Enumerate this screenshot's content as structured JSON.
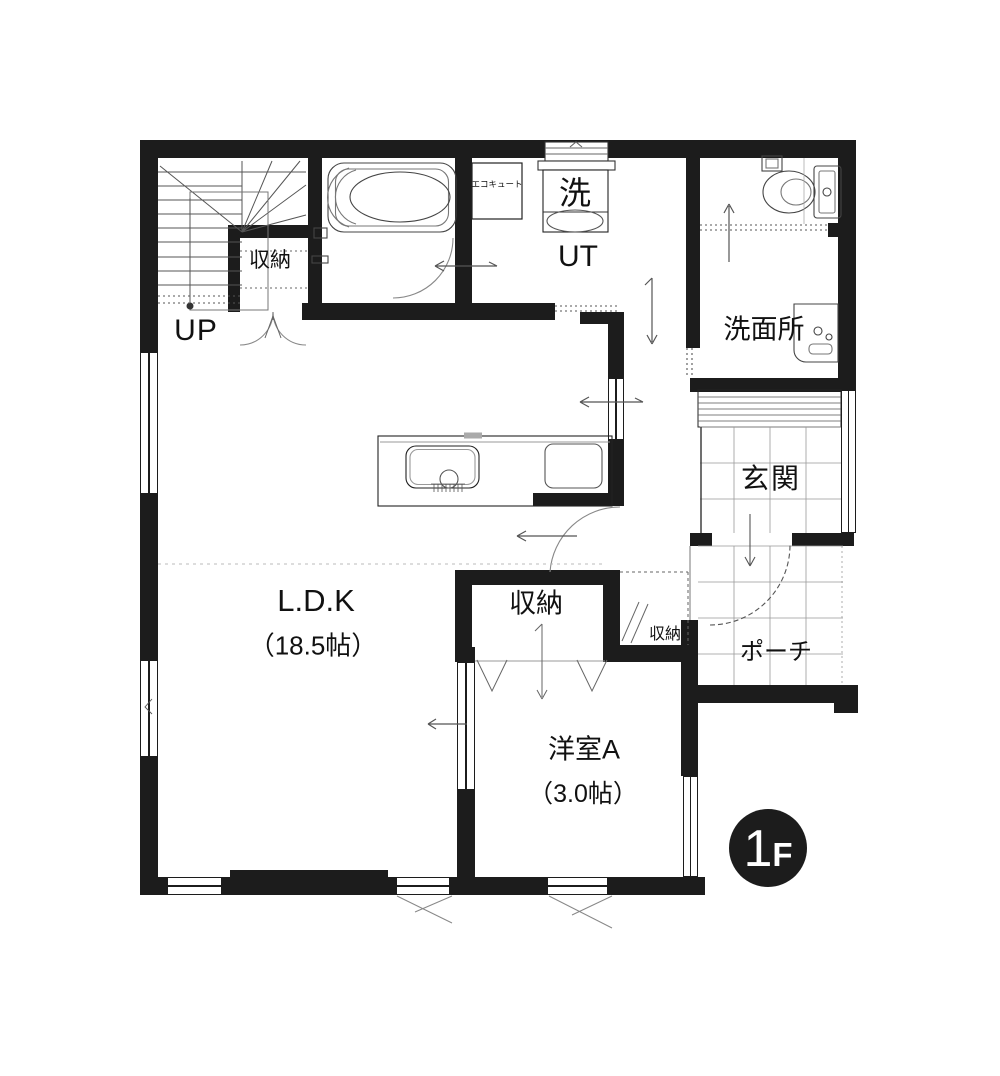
{
  "floor_badge": {
    "number": "1",
    "suffix": "F"
  },
  "rooms": {
    "stairs": {
      "label": "UP"
    },
    "closet_stairs": {
      "label": "収納"
    },
    "ecocute": {
      "label": "エコキュート"
    },
    "laundry": {
      "label": "洗"
    },
    "utility": {
      "label": "UT"
    },
    "washroom": {
      "label": "洗面所"
    },
    "entrance": {
      "label": "玄関"
    },
    "porch": {
      "label": "ポーチ"
    },
    "ldk": {
      "name": "L.D.K",
      "size": "（18.5帖）"
    },
    "closet_center": {
      "label": "収納"
    },
    "closet_small": {
      "label": "収納"
    },
    "western_a": {
      "name": "洋室A",
      "size": "（3.0帖）"
    }
  },
  "colors": {
    "wall": "#1c1c1c",
    "line": "#444444",
    "grid": "#999999",
    "bg": "#ffffff"
  }
}
